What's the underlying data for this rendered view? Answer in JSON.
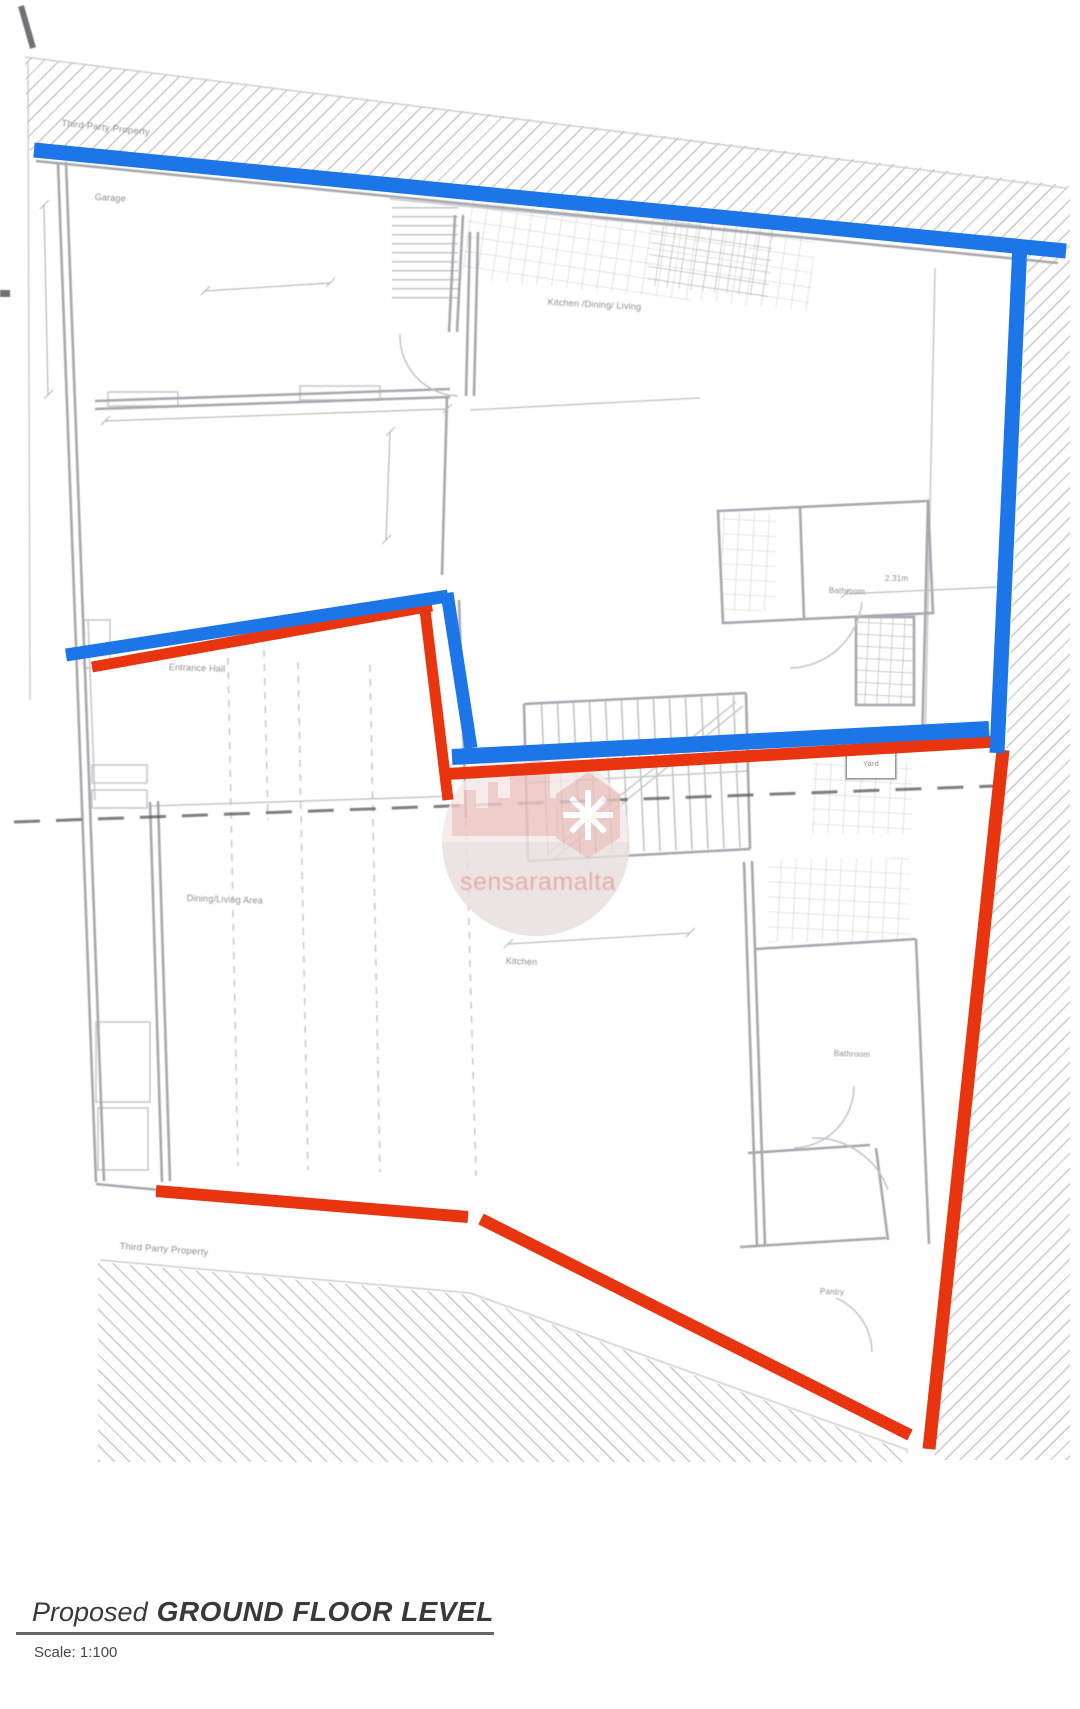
{
  "plan": {
    "labels": {
      "third_party_top": "Third Party Property",
      "garage": "Garage",
      "kitchen_dining_living": "Kitchen /Dining/ Living",
      "bathroom_upper": "Bathroom",
      "entrance_hall": "Entrance Hall",
      "dining_living_area": "Dining/Living Area",
      "kitchen": "Kitchen",
      "bathroom_lower": "Bathroom",
      "pantry": "Pantry",
      "third_party_bottom": "Third Party Property",
      "yard": "Yard"
    },
    "dimensions": {
      "bathroom_upper_width": "2.31m"
    },
    "annotation_colors": {
      "blue": "#1d76e8",
      "red": "#e8350f"
    }
  },
  "watermark": {
    "text": "sensaramalta"
  },
  "title_block": {
    "prefix": "Proposed",
    "title": "GROUND FLOOR LEVEL",
    "scale": "Scale: 1:100"
  }
}
